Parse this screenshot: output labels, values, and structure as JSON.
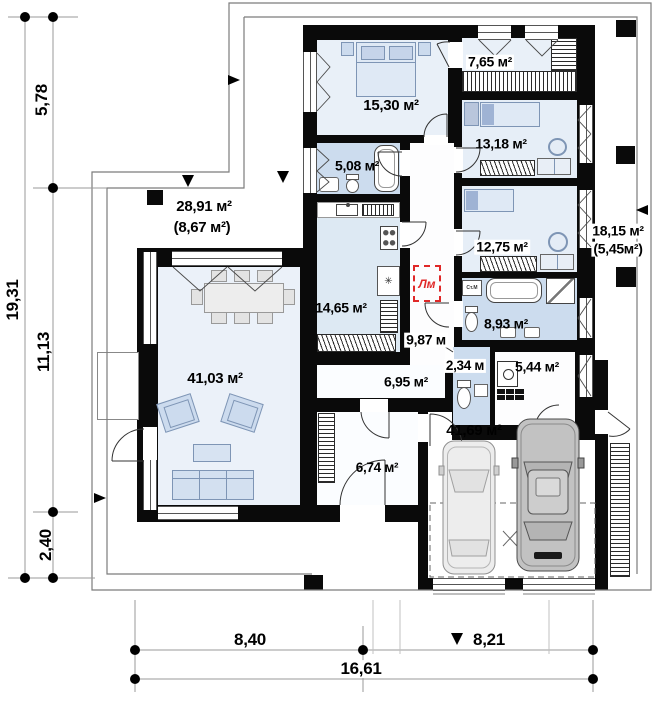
{
  "plan": {
    "rooms": {
      "living": {
        "area": "41,03 м²"
      },
      "kitchen": {
        "area": "14,65 м²"
      },
      "bath_small": {
        "area": "5,08 м²"
      },
      "bedroom_main": {
        "area": "15,30 м²"
      },
      "wardrobe": {
        "area": "7,65 м²"
      },
      "bedroom_mid": {
        "area": "13,18 м²"
      },
      "bedroom_small": {
        "area": "12,75 м²"
      },
      "bath_main": {
        "area": "8,93 м²"
      },
      "wc": {
        "area": "2,34 м"
      },
      "boiler_room": {
        "area": "5,44 м²"
      },
      "hall": {
        "area": "9,87 м"
      },
      "corridor": {
        "area": "6,95 м²"
      },
      "vestibule": {
        "area": "6,74 м²"
      },
      "garage": {
        "area": "41,69 м²"
      },
      "terrace_front": {
        "area": "28,91 м²",
        "area_secondary": "(8,67 м²)"
      },
      "terrace_side": {
        "area": "18,15 м²",
        "area_secondary": "(5,45м²)"
      }
    },
    "markers": {
      "attic_ladder": "Лм",
      "washing_machine": "Ст.М"
    },
    "dimensions": {
      "left_total": "19,31",
      "left_segments": [
        "5,78",
        "11,13",
        "2,40"
      ],
      "bottom_segments": [
        "8,40",
        "8,21"
      ],
      "bottom_total": "16,61"
    },
    "colors": {
      "wall": "#0a0a0a",
      "room": "#e9f0f8",
      "wet_room": "#ccdcee",
      "marker_red": "#e02828"
    }
  }
}
